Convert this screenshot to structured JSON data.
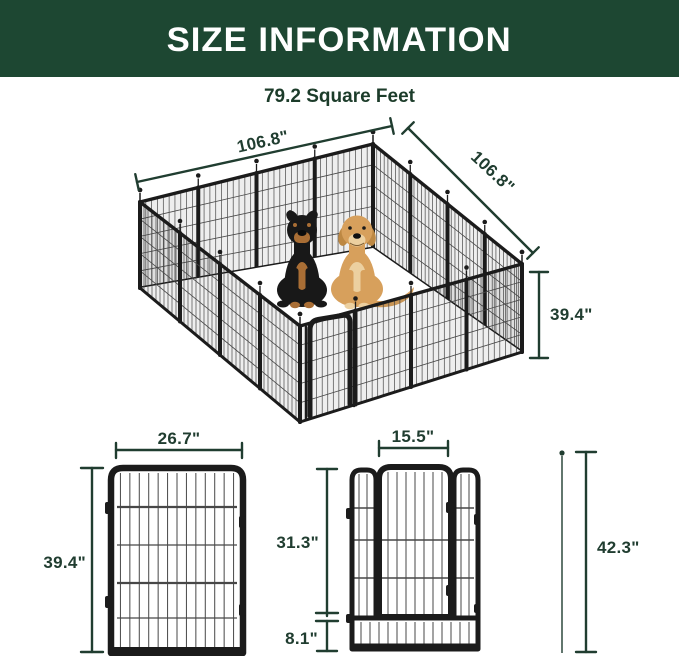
{
  "header": {
    "title": "SIZE INFORMATION"
  },
  "subtitle": "79.2 Square Feet",
  "pen": {
    "dim_left_width": "106.8\"",
    "dim_right_width": "106.8\"",
    "dim_height": "39.4\""
  },
  "flat_panel": {
    "dim_width": "26.7\"",
    "dim_height": "39.4\""
  },
  "door_panel": {
    "dim_width": "15.5\"",
    "dim_upper_height": "31.3\"",
    "dim_lower_height": "8.1\"",
    "dim_total_height": "42.3\""
  },
  "illustrations": {
    "pen": "metal-playpen-isometric-16-panels-with-gate",
    "dogs": [
      "rottweiler",
      "golden-retriever"
    ],
    "accessory": "ground-stake"
  },
  "colors": {
    "header_bg": "#1d4732",
    "header_text": "#ffffff",
    "subtitle_text": "#1c3c2a",
    "dimension": "#203d30",
    "fence_frame": "#1b1b1b",
    "fence_wire": "#474747",
    "dog_black": "#181818",
    "dog_tan": "#a96e35",
    "dog_golden": "#d7a05c"
  }
}
